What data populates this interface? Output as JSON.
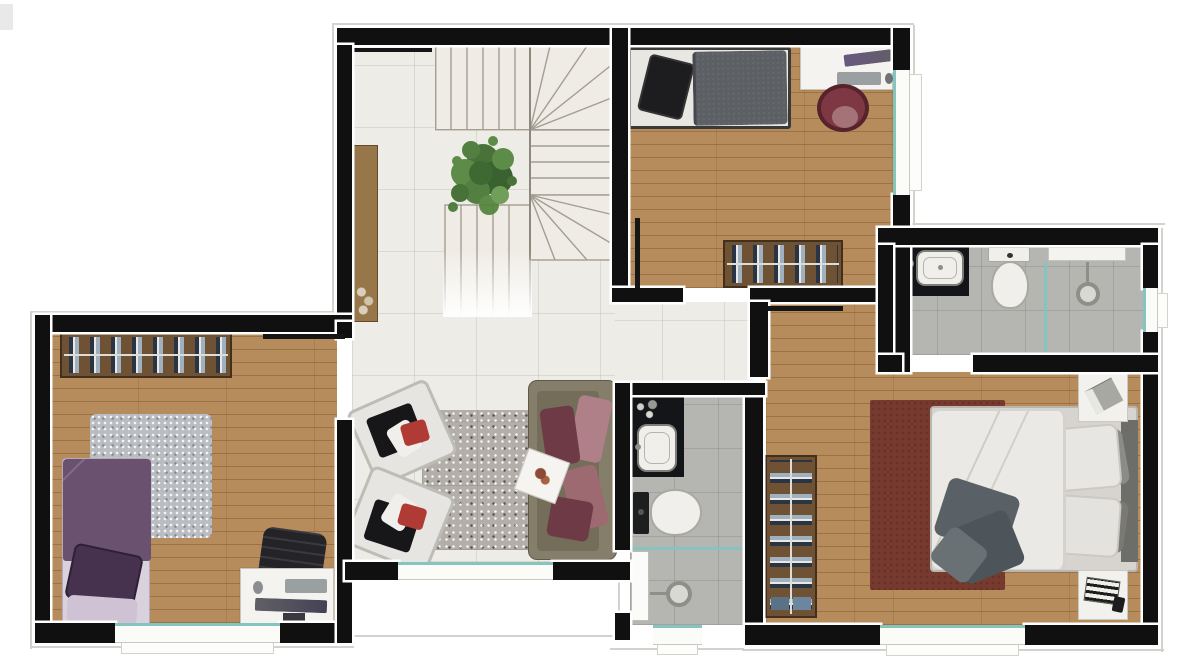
{
  "title": "apartment-upper-floor-plan",
  "palette": {
    "wall": "#101010",
    "outline": "#d3d3ce",
    "tile": "#edece7",
    "wood": "#b78c5c",
    "bathFloor": "#b5b5b1",
    "glass": "#85c5bd",
    "railWood": "#6f5233",
    "railLine": "#dcdcd8",
    "clothA": "#2a3442",
    "clothB": "#9fb0bf",
    "clothC": "#e8e8e8",
    "deskWhite": "#f4f3f0",
    "rugSpeckle": "#b3afa8",
    "rugGray": "#b9bcc1",
    "rugMaroon": "#763a2f",
    "porcelain": "#f0efeb",
    "counterBlack": "#141518",
    "monitor": "#3b3544",
    "keyboard": "#9aa0a2",
    "bedPurple": "#6a5170",
    "pillowPurple": "#46324e",
    "sheetPurple": "#d9d2dc",
    "bedWhite": "#e9e7e2",
    "pillowBlack": "#1d1d1f",
    "duvetGray": "#5c5f63",
    "roundChair": "#7e3843",
    "officeChair": "#242428",
    "sofaFrame": "#857e6a",
    "sofaSeat": "#746d5a",
    "cushionRose": "#9d6a72",
    "cushionMaroon": "#6d3a46",
    "cushionPale": "#b08089",
    "armchairWhite": "#e6e5e1",
    "armchairTrim": "#bdbcb7",
    "accentRed": "#b03a34",
    "duvetWhite": "#ebe9e5",
    "mattress": "#d7d4cf",
    "headboard": "#6d6d6a",
    "blanket": "#596166",
    "nightstand": "#f2f1ed",
    "sideboard": "#97774a",
    "stairTread": "#efece5",
    "stairLine": "#a49d91",
    "plantGreen": "#4a7a38"
  },
  "rooms": [
    {
      "name": "hall-landing",
      "floor": "tile",
      "items": [
        "u-shaped-staircase",
        "potted-plant",
        "sideboard",
        "stair-railing"
      ]
    },
    {
      "name": "bedroom-top-right",
      "floor": "wood",
      "items": [
        "single-bed",
        "desk",
        "monitor",
        "keyboard",
        "mouse",
        "round-chair",
        "clothes-rack",
        "window"
      ]
    },
    {
      "name": "bathroom-top-right",
      "floor": "gray-tile",
      "items": [
        "vanity-counter",
        "sink",
        "toilet",
        "glass-partition",
        "shower-head",
        "niche",
        "window"
      ]
    },
    {
      "name": "bedroom-bottom-left",
      "floor": "wood",
      "items": [
        "single-bed",
        "shag-rug",
        "clothes-rack",
        "desk",
        "office-chair",
        "monitor",
        "keyboard",
        "mouse",
        "window"
      ]
    },
    {
      "name": "living-area",
      "floor": "tile",
      "items": [
        "sofa",
        "armchair",
        "armchair",
        "speckled-rug",
        "side-table",
        "window",
        "terrace-outline"
      ]
    },
    {
      "name": "bathroom-center",
      "floor": "gray-tile",
      "items": [
        "vanity-counter",
        "sink",
        "toilet",
        "glass-partition",
        "shower-head",
        "door-leaf",
        "window"
      ]
    },
    {
      "name": "master-bedroom",
      "floor": "wood",
      "items": [
        "double-bed",
        "maroon-rug",
        "clothes-rack",
        "nightstand",
        "nightstand",
        "window",
        "door-leaf"
      ]
    }
  ]
}
